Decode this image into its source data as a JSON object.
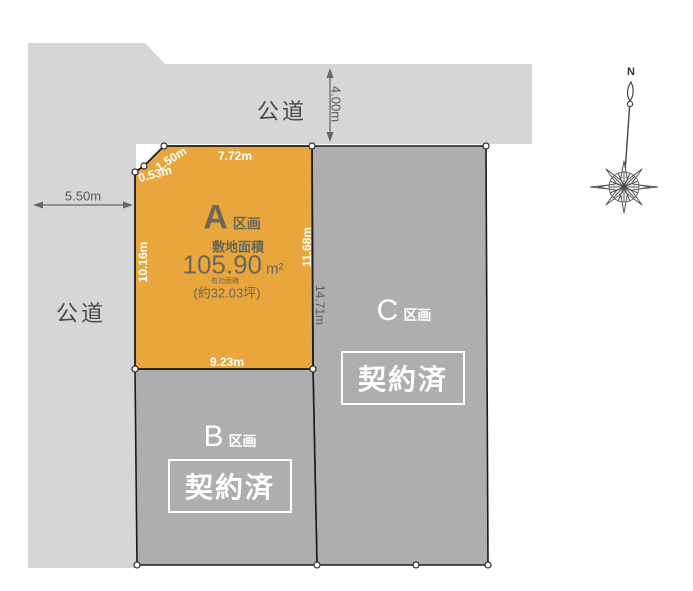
{
  "colors": {
    "road": "#d6d6d6",
    "plot_a_fill": "#e9a63c",
    "plot_sold_fill": "#aeaeae",
    "outline": "#1a1a1a",
    "dim_dark_text": "#5a5a5a",
    "white_text": "#ffffff",
    "plot_a_text": "#6b685a"
  },
  "roads": {
    "top_label": "公道",
    "left_label": "公道"
  },
  "dimensions": {
    "top_road_width": "4.00m",
    "left_road_width": "5.50m",
    "a_top_edge": "7.72m",
    "a_corner_upper": "1.50m",
    "a_corner_lower": "0.53m",
    "a_left_edge": "10.16m",
    "a_right_edge": "11.68m",
    "a_bottom_edge": "9.23m",
    "c_left_edge": "14.71m"
  },
  "plots": {
    "a": {
      "letter": "A",
      "suffix": "区画",
      "area_label": "敷地面積",
      "area_value": "105.90",
      "area_unit": "m²",
      "sub_label": "有効面積",
      "tsubo_value": "(約32.03坪)"
    },
    "b": {
      "letter": "B",
      "suffix": "区画",
      "status": "契約済"
    },
    "c": {
      "letter": "C",
      "suffix": "区画",
      "status": "契約済"
    }
  },
  "compass": {
    "north_label": "N"
  }
}
